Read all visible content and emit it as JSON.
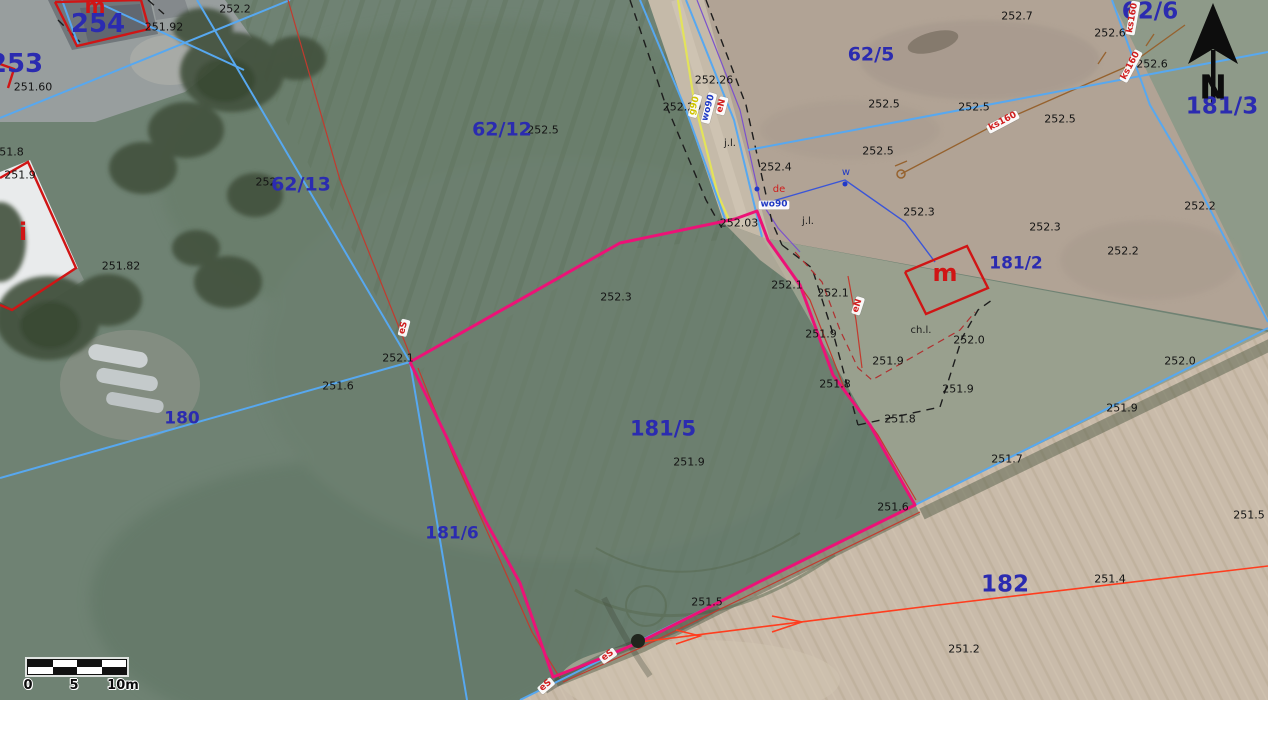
{
  "north": {
    "letter": "N"
  },
  "scalebar": {
    "t0": "0",
    "t5": "5",
    "t10": "10m"
  },
  "colors": {
    "parcel_number": "#2b2bb0",
    "elevation_text": "#141414",
    "parcel_boundary_magenta": "#ec1277",
    "cadastral_blue": "#57a8f0",
    "building_red": "#d01515",
    "survey_red": "#c23a2e",
    "arrow_line_orange": "#ff3d1e"
  },
  "labels": {
    "parcels": [
      {
        "t": "254",
        "x": 98,
        "y": 24,
        "s": 26
      },
      {
        "t": "253",
        "x": 16,
        "y": 64,
        "s": 26
      },
      {
        "t": "62/12",
        "x": 502,
        "y": 130,
        "s": 19
      },
      {
        "t": "62/13",
        "x": 301,
        "y": 185,
        "s": 19
      },
      {
        "t": "62/5",
        "x": 871,
        "y": 55,
        "s": 19
      },
      {
        "t": "62/6",
        "x": 1150,
        "y": 12,
        "s": 23
      },
      {
        "t": "181/3",
        "x": 1222,
        "y": 107,
        "s": 23
      },
      {
        "t": "181/2",
        "x": 1016,
        "y": 264,
        "s": 17
      },
      {
        "t": "181/5",
        "x": 663,
        "y": 429,
        "s": 21
      },
      {
        "t": "181/6",
        "x": 452,
        "y": 534,
        "s": 17
      },
      {
        "t": "180",
        "x": 182,
        "y": 419,
        "s": 17
      },
      {
        "t": "182",
        "x": 1005,
        "y": 585,
        "s": 23
      }
    ],
    "buildings": [
      {
        "t": "m",
        "x": 95,
        "y": 6,
        "s": 20
      },
      {
        "t": "m",
        "x": 945,
        "y": 273,
        "s": 24
      },
      {
        "t": "i",
        "x": 23,
        "y": 232,
        "s": 24
      }
    ],
    "elevations": [
      {
        "t": "252.2",
        "x": 235,
        "y": 9
      },
      {
        "t": "251.92",
        "x": 164,
        "y": 27
      },
      {
        "t": "251.60",
        "x": 33,
        "y": 87
      },
      {
        "t": "251.8",
        "x": 8,
        "y": 152
      },
      {
        "t": "251.9",
        "x": 20,
        "y": 175
      },
      {
        "t": "251.82",
        "x": 121,
        "y": 266
      },
      {
        "t": "252",
        "x": 266,
        "y": 182
      },
      {
        "t": "252.5",
        "x": 543,
        "y": 130
      },
      {
        "t": "252.7",
        "x": 1017,
        "y": 16
      },
      {
        "t": "252.6",
        "x": 1110,
        "y": 33
      },
      {
        "t": "252.6",
        "x": 1152,
        "y": 64
      },
      {
        "t": "252.5",
        "x": 884,
        "y": 104
      },
      {
        "t": "252.5",
        "x": 974,
        "y": 107
      },
      {
        "t": "252.5",
        "x": 1060,
        "y": 119
      },
      {
        "t": "252.5",
        "x": 878,
        "y": 151
      },
      {
        "t": "252.26",
        "x": 714,
        "y": 80
      },
      {
        "t": "252.29",
        "x": 682,
        "y": 107
      },
      {
        "t": "252.4",
        "x": 776,
        "y": 167
      },
      {
        "t": "252.3",
        "x": 919,
        "y": 212
      },
      {
        "t": "252.3",
        "x": 1045,
        "y": 227
      },
      {
        "t": "252.2",
        "x": 1200,
        "y": 206
      },
      {
        "t": "252.2",
        "x": 1123,
        "y": 251
      },
      {
        "t": "252.03",
        "x": 739,
        "y": 223
      },
      {
        "t": "252.3",
        "x": 616,
        "y": 297
      },
      {
        "t": "252.1",
        "x": 787,
        "y": 285
      },
      {
        "t": "252.1",
        "x": 833,
        "y": 293
      },
      {
        "t": "252.1",
        "x": 398,
        "y": 358
      },
      {
        "t": "251.6",
        "x": 338,
        "y": 386
      },
      {
        "t": "251.9",
        "x": 821,
        "y": 334
      },
      {
        "t": "251.8",
        "x": 835,
        "y": 384
      },
      {
        "t": "251.9",
        "x": 888,
        "y": 361
      },
      {
        "t": "251.9",
        "x": 958,
        "y": 389
      },
      {
        "t": "251.8",
        "x": 900,
        "y": 419
      },
      {
        "t": "251.9",
        "x": 689,
        "y": 462
      },
      {
        "t": "251.7",
        "x": 1007,
        "y": 459
      },
      {
        "t": "251.9",
        "x": 1122,
        "y": 408
      },
      {
        "t": "252.0",
        "x": 1180,
        "y": 361
      },
      {
        "t": "252.0",
        "x": 969,
        "y": 340
      },
      {
        "t": "251.6",
        "x": 893,
        "y": 507
      },
      {
        "t": "251.5",
        "x": 1249,
        "y": 515
      },
      {
        "t": "251.4",
        "x": 1110,
        "y": 579
      },
      {
        "t": "251.2",
        "x": 964,
        "y": 649
      },
      {
        "t": "251.5",
        "x": 707,
        "y": 602
      }
    ],
    "pills": [
      {
        "t": "g90",
        "x": 695,
        "y": 106,
        "r": -75,
        "c": "yellow"
      },
      {
        "t": "wo90",
        "x": 709,
        "y": 108,
        "r": -75,
        "c": "blue"
      },
      {
        "t": "eN",
        "x": 722,
        "y": 106,
        "r": -75,
        "c": "red"
      },
      {
        "t": "wo90",
        "x": 774,
        "y": 205,
        "r": 0,
        "c": "blue"
      },
      {
        "t": "ks160",
        "x": 1003,
        "y": 122,
        "r": -28,
        "c": "red"
      },
      {
        "t": "ks160",
        "x": 1131,
        "y": 66,
        "r": -62,
        "c": "red"
      },
      {
        "t": "ks160",
        "x": 1133,
        "y": 18,
        "r": -80,
        "c": "red"
      },
      {
        "t": "eN",
        "x": 858,
        "y": 306,
        "r": -72,
        "c": "red"
      },
      {
        "t": "eS",
        "x": 404,
        "y": 328,
        "r": -75,
        "c": "red"
      },
      {
        "t": "eS",
        "x": 608,
        "y": 656,
        "r": -35,
        "c": "red"
      },
      {
        "t": "eS",
        "x": 546,
        "y": 686,
        "r": -40,
        "c": "red"
      }
    ],
    "notes": [
      {
        "t": "j.l.",
        "x": 730,
        "y": 144,
        "c": "dark"
      },
      {
        "t": "j.l.",
        "x": 808,
        "y": 222,
        "c": "dark"
      },
      {
        "t": "ch.l.",
        "x": 921,
        "y": 331,
        "c": "dark"
      },
      {
        "t": "w",
        "x": 846,
        "y": 173,
        "c": "blue"
      },
      {
        "t": "de",
        "x": 779,
        "y": 190,
        "c": "red"
      }
    ]
  },
  "geometry": {
    "lines": [
      {
        "c": "brown",
        "n": "sewer-line-ks160",
        "p": [
          [
            901,
            174
          ],
          [
            1000,
            122
          ],
          [
            1128,
            66
          ],
          [
            1185,
            25
          ]
        ]
      },
      {
        "c": "brown",
        "n": "sewer-line-tick",
        "p": [
          [
            1098,
            64
          ],
          [
            1106,
            52
          ]
        ]
      },
      {
        "c": "brown",
        "n": "sewer-line-tick",
        "p": [
          [
            1146,
            46
          ],
          [
            1154,
            34
          ]
        ]
      },
      {
        "c": "brown",
        "n": "sewer-line-tick",
        "p": [
          [
            895,
            166
          ],
          [
            907,
            161
          ]
        ]
      },
      {
        "c": "purple",
        "n": "utility-line-purple",
        "p": [
          [
            697,
            0
          ],
          [
            740,
            110
          ],
          [
            760,
            200
          ],
          [
            778,
            228
          ],
          [
            800,
            252
          ]
        ]
      },
      {
        "c": "wblue",
        "n": "water-connection-line",
        "p": [
          [
            766,
            203
          ],
          [
            845,
            180
          ],
          [
            905,
            222
          ],
          [
            935,
            262
          ]
        ]
      },
      {
        "c": "yellow",
        "n": "gas-line",
        "p": [
          [
            678,
            0
          ],
          [
            694,
            100
          ],
          [
            718,
            195
          ],
          [
            730,
            222
          ]
        ]
      },
      {
        "c": "blackdash",
        "n": "terrain-edge-dashed",
        "p": [
          [
            630,
            0
          ],
          [
            664,
            100
          ],
          [
            706,
            200
          ],
          [
            724,
            232
          ]
        ]
      },
      {
        "c": "blackdash",
        "n": "terrain-edge-dashed",
        "p": [
          [
            706,
            0
          ],
          [
            746,
            105
          ],
          [
            772,
            222
          ],
          [
            782,
            245
          ]
        ]
      },
      {
        "c": "blackdash",
        "n": "terrain-edge-dashed",
        "p": [
          [
            782,
            245
          ],
          [
            812,
            268
          ],
          [
            835,
            340
          ],
          [
            858,
            425
          ]
        ]
      },
      {
        "c": "blackdash",
        "n": "terrain-edge-dashed",
        "p": [
          [
            858,
            425
          ],
          [
            940,
            407
          ],
          [
            962,
            338
          ],
          [
            978,
            310
          ],
          [
            992,
            300
          ]
        ]
      },
      {
        "c": "blackdash",
        "n": "terrain-edge-dashed",
        "p": [
          [
            148,
            0
          ],
          [
            164,
            14
          ]
        ]
      },
      {
        "c": "blackdash",
        "n": "terrain-edge-dashed",
        "p": [
          [
            58,
            20
          ],
          [
            80,
            42
          ]
        ]
      },
      {
        "c": "blue",
        "n": "cadastral-line",
        "p": [
          [
            197,
            0
          ],
          [
            410,
            362
          ]
        ]
      },
      {
        "c": "blue",
        "n": "cadastral-line",
        "p": [
          [
            410,
            362
          ],
          [
            467,
            700
          ]
        ]
      },
      {
        "c": "blue",
        "n": "cadastral-line",
        "p": [
          [
            0,
            478
          ],
          [
            410,
            362
          ]
        ]
      },
      {
        "c": "blue",
        "n": "cadastral-line",
        "p": [
          [
            0,
            118
          ],
          [
            290,
            0
          ]
        ]
      },
      {
        "c": "blue",
        "n": "cadastral-line",
        "p": [
          [
            92,
            0
          ],
          [
            244,
            70
          ]
        ]
      },
      {
        "c": "blue",
        "n": "cadastral-line",
        "p": [
          [
            62,
            0
          ],
          [
            78,
            44
          ]
        ]
      },
      {
        "c": "blue",
        "n": "cadastral-line",
        "p": [
          [
            640,
            0
          ],
          [
            686,
            110
          ],
          [
            726,
            222
          ]
        ]
      },
      {
        "c": "blue",
        "n": "cadastral-line",
        "p": [
          [
            686,
            0
          ],
          [
            734,
            120
          ],
          [
            762,
            237
          ]
        ]
      },
      {
        "c": "blue",
        "n": "cadastral-line",
        "p": [
          [
            748,
            150
          ],
          [
            1268,
            52
          ]
        ]
      },
      {
        "c": "blue",
        "n": "cadastral-line",
        "p": [
          [
            1112,
            0
          ],
          [
            1150,
            105
          ],
          [
            1200,
            190
          ],
          [
            1268,
            322
          ]
        ]
      },
      {
        "c": "blue",
        "n": "cadastral-line",
        "p": [
          [
            1268,
            328
          ],
          [
            915,
            505
          ],
          [
            520,
            700
          ]
        ]
      },
      {
        "c": "red",
        "n": "survey-line-red",
        "p": [
          [
            288,
            0
          ],
          [
            340,
            180
          ],
          [
            412,
            360
          ]
        ]
      },
      {
        "c": "red",
        "n": "survey-line-red",
        "p": [
          [
            418,
            368
          ],
          [
            455,
            460
          ],
          [
            500,
            560
          ],
          [
            532,
            632
          ],
          [
            560,
            678
          ]
        ]
      },
      {
        "c": "red",
        "n": "survey-line-red",
        "p": [
          [
            563,
            682
          ],
          [
            640,
            648
          ],
          [
            770,
            585
          ],
          [
            920,
            512
          ]
        ]
      },
      {
        "c": "red",
        "n": "survey-line-red",
        "p": [
          [
            770,
            243
          ],
          [
            810,
            300
          ],
          [
            845,
            390
          ],
          [
            878,
            435
          ],
          [
            916,
            500
          ]
        ]
      },
      {
        "c": "red",
        "n": "survey-line-red",
        "p": [
          [
            848,
            276
          ],
          [
            856,
            320
          ],
          [
            862,
            368
          ]
        ]
      },
      {
        "c": "reddash",
        "n": "survey-line-red-dashed",
        "p": [
          [
            795,
            252
          ],
          [
            822,
            282
          ],
          [
            840,
            330
          ],
          [
            858,
            368
          ],
          [
            872,
            380
          ],
          [
            960,
            330
          ],
          [
            975,
            312
          ]
        ]
      },
      {
        "c": "orange",
        "n": "parcel-182-boundary",
        "p": [
          [
            640,
            642
          ],
          [
            930,
            606
          ],
          [
            1268,
            566
          ]
        ]
      },
      {
        "c": "orange",
        "n": "boundary-arrowhead",
        "p": [
          [
            676,
            644
          ],
          [
            700,
            636
          ],
          [
            676,
            630
          ]
        ]
      },
      {
        "c": "orange",
        "n": "boundary-arrowhead",
        "p": [
          [
            772,
            632
          ],
          [
            802,
            622
          ],
          [
            772,
            616
          ]
        ]
      },
      {
        "c": "magenta",
        "n": "parcel-181-5-boundary",
        "p": [
          [
            410,
            362
          ],
          [
            620,
            243
          ],
          [
            735,
            219
          ],
          [
            757,
            211
          ],
          [
            768,
            240
          ],
          [
            800,
            285
          ],
          [
            833,
            375
          ],
          [
            870,
            425
          ],
          [
            915,
            505
          ],
          [
            763,
            580
          ],
          [
            640,
            642
          ],
          [
            602,
            658
          ],
          [
            553,
            677
          ],
          [
            520,
            583
          ],
          [
            485,
            520
          ],
          [
            448,
            440
          ],
          [
            410,
            362
          ]
        ]
      },
      {
        "c": "bred",
        "n": "building-outline-254",
        "p": [
          [
            55,
            2
          ],
          [
            141,
            0
          ],
          [
            149,
            29
          ],
          [
            77,
            46
          ],
          [
            55,
            2
          ]
        ]
      },
      {
        "c": "bred",
        "n": "building-outline-253",
        "p": [
          [
            0,
            64
          ],
          [
            14,
            69
          ],
          [
            8,
            88
          ]
        ]
      },
      {
        "c": "bred",
        "n": "building-outline-i",
        "p": [
          [
            0,
            178
          ],
          [
            28,
            162
          ],
          [
            76,
            268
          ],
          [
            12,
            310
          ],
          [
            0,
            305
          ]
        ]
      },
      {
        "c": "bred",
        "n": "building-outline-m",
        "p": [
          [
            905,
            272
          ],
          [
            967,
            246
          ],
          [
            988,
            288
          ],
          [
            926,
            314
          ],
          [
            905,
            272
          ]
        ]
      }
    ],
    "dots": [
      {
        "x": 901,
        "y": 174,
        "r": 4,
        "c": "brown-ring",
        "n": "sewer-node"
      },
      {
        "x": 845,
        "y": 184,
        "r": 2.5,
        "c": "blue-dot",
        "n": "water-node"
      },
      {
        "x": 757,
        "y": 189,
        "r": 2.5,
        "c": "blue-dot",
        "n": "water-node"
      },
      {
        "x": 638,
        "y": 641,
        "r": 7,
        "c": "dark-blob",
        "n": "bush"
      }
    ]
  }
}
